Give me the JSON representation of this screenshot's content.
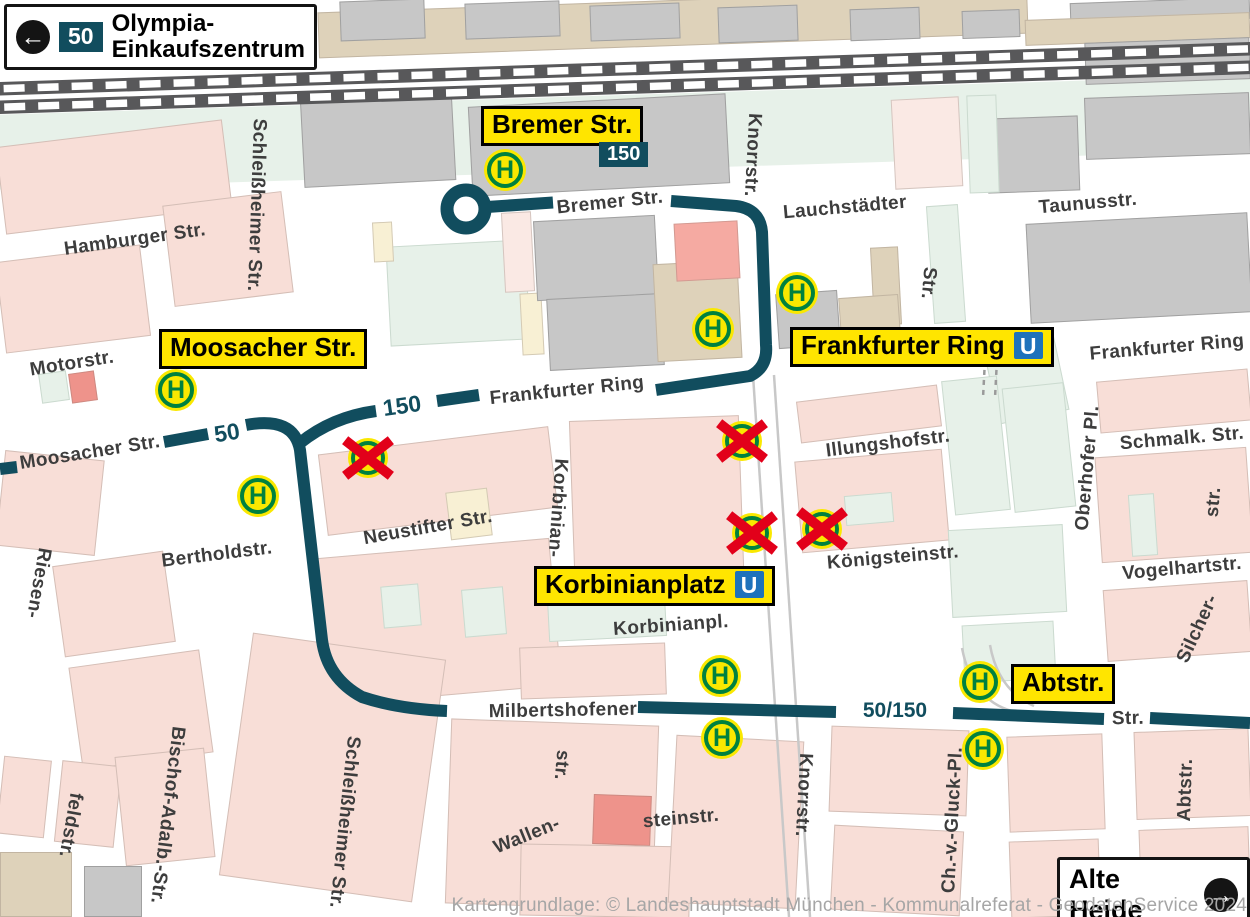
{
  "colors": {
    "route_teal": "#114d5e",
    "label_yellow": "#ffe500",
    "ubahn_blue": "#1e72bb",
    "stop_green": "#00813f",
    "stop_yellow": "#fae800",
    "cancel_red": "#e2001a",
    "railway_gray": "#58585a"
  },
  "sign_olympia": {
    "route": "50",
    "line1": "Olympia-",
    "line2": "Einkaufszentrum",
    "arrow": "←"
  },
  "sign_alte_heide": {
    "label": "Alte Heide",
    "arrow": "→"
  },
  "labels": {
    "bremer": {
      "text": "Bremer Str.",
      "route_badge": "150"
    },
    "moosacher": {
      "text": "Moosacher Str."
    },
    "frankfurter": {
      "text": "Frankfurter Ring",
      "u": "U"
    },
    "korbinianplatz": {
      "text": "Korbinianplatz",
      "u": "U"
    },
    "abtstr": {
      "text": "Abtstr."
    }
  },
  "route_markers": {
    "m50": "50",
    "m150": "150",
    "m50150": "50/150"
  },
  "stop_letter": "H",
  "streets": {
    "hamburger": "Hamburger Str.",
    "schleissheimer_top": "Schleißheimer Str.",
    "knorr_top": "Knorrstr.",
    "bremer": "Bremer Str.",
    "lauchstaedter": "Lauchstädter",
    "lauch_str": "Str.",
    "taunus": "Taunusstr.",
    "motor": "Motorstr.",
    "moosacher": "Moosacher Str.",
    "frankfurter_mid": "Frankfurter Ring",
    "frankfurter_right": "Frankfurter Ring",
    "illungshof": "Illungshofstr.",
    "oberhofer": "Oberhofer Pl.",
    "schmalk": "Schmalk. Str.",
    "str_right": "str.",
    "neustifter": "Neustifter Str.",
    "korbinian_v": "Korbinian-",
    "berthold": "Bertholdstr.",
    "riesen": "Riesen-",
    "koenigstein": "Königsteinstr.",
    "vogelhart": "Vogelhartstr.",
    "korbinianpl": "Korbinianpl.",
    "silcher": "Silcher-",
    "milbertshofener": "Milbertshofener",
    "milb_str": "Str.",
    "schleissheimer_bottom": "Schleißheimer Str.",
    "bischof": "Bischof-Adalb.-Str.",
    "feld": "feldstr.",
    "wallen": "Wallen-",
    "stein": "steinstr.",
    "str_bottom": "str.",
    "knorr_bottom": "Knorrstr.",
    "gluck": "Ch.-v.-Gluck-Pl.",
    "abt_v": "Abtstr."
  },
  "attribution": "Kartengrundlage: © Landeshauptstadt München - Kommunalreferat - GeodatenService 2024"
}
